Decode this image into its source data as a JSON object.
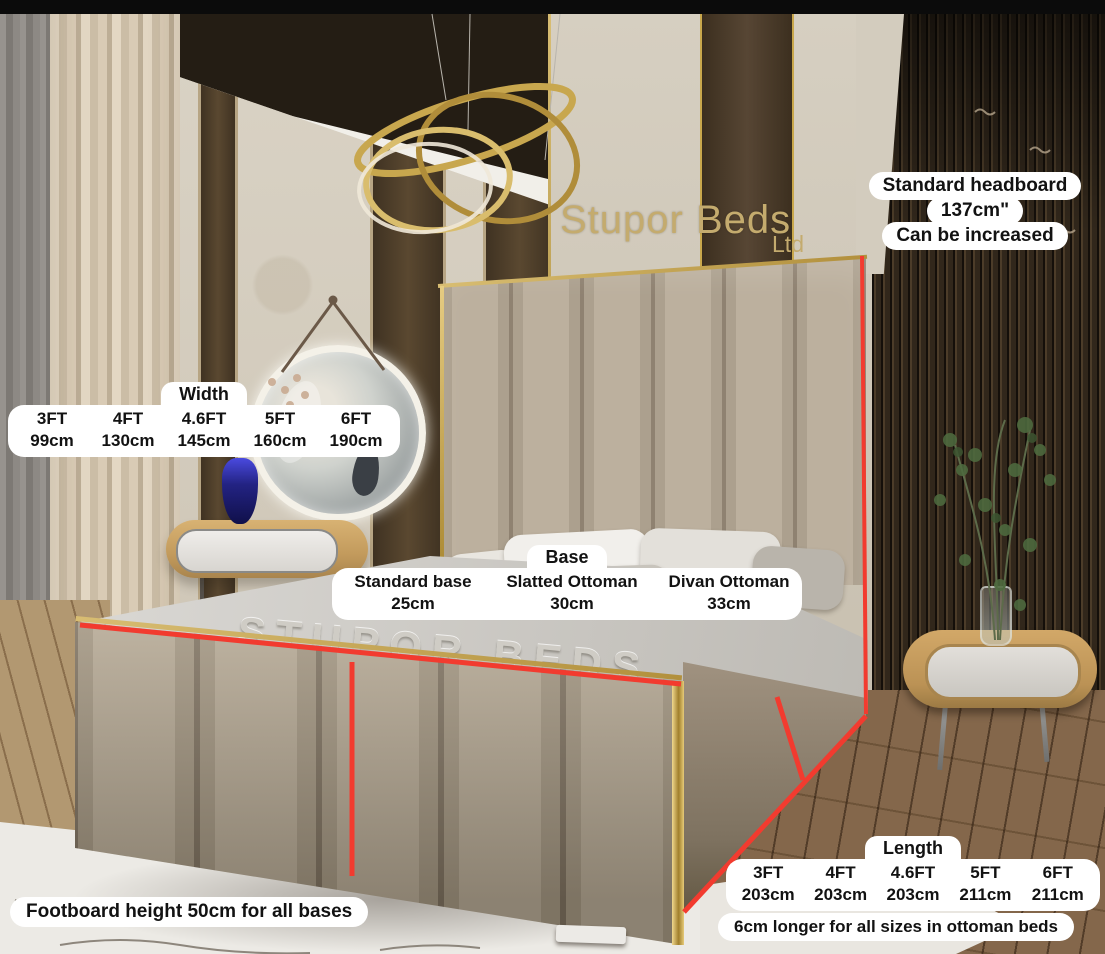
{
  "scene": {
    "wall_sign": {
      "line1": "Stupor Beds",
      "line2": "Ltd"
    },
    "bed_runner_text": "STUPOR BEDS"
  },
  "headboard_note": {
    "line1": "Standard headboard",
    "line2": "137cm\"",
    "line3": "Can be increased"
  },
  "width_table": {
    "title": "Width",
    "sizes": [
      "3FT",
      "4FT",
      "4.6FT",
      "5FT",
      "6FT"
    ],
    "values": [
      "99cm",
      "130cm",
      "145cm",
      "160cm",
      "190cm"
    ]
  },
  "base_table": {
    "title": "Base",
    "options": [
      "Standard base",
      "Slatted Ottoman",
      "Divan Ottoman"
    ],
    "values": [
      "25cm",
      "30cm",
      "33cm"
    ]
  },
  "length_table": {
    "title": "Length",
    "sizes": [
      "3FT",
      "4FT",
      "4.6FT",
      "5FT",
      "6FT"
    ],
    "values": [
      "203cm",
      "203cm",
      "203cm",
      "211cm",
      "211cm"
    ]
  },
  "notes": {
    "footboard": "Footboard height 50cm for all bases",
    "ottoman": "6cm longer for all sizes in ottoman beds"
  },
  "colors": {
    "annotation_red": "#f23b2f",
    "gold_trim": "#c9a84c",
    "pill_bg": "#ffffff",
    "pill_text": "#121212"
  }
}
